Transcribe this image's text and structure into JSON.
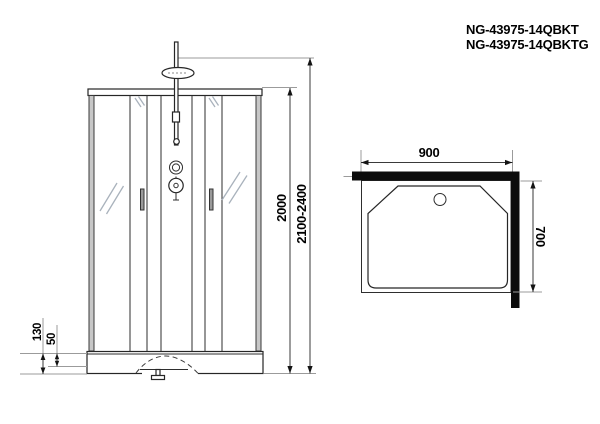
{
  "header": {
    "model_line1": "NG-43975-14QBKT",
    "model_line2": "NG-43975-14QBKTG"
  },
  "front_view": {
    "dims": {
      "inner_height": "2000",
      "total_height": "2100-2400",
      "tray_height": "130",
      "tray_lip": "50"
    }
  },
  "top_view": {
    "dims": {
      "width": "900",
      "depth": "700"
    }
  },
  "colors": {
    "line": "#262626",
    "dimension_line": "#3a3a3a",
    "extension_line": "#9b9b9b",
    "wall_fill": "#0c0c0c",
    "frame_fill": "#c7c7c7",
    "glass_shine": "#a9b2bc",
    "text": "#000000"
  }
}
